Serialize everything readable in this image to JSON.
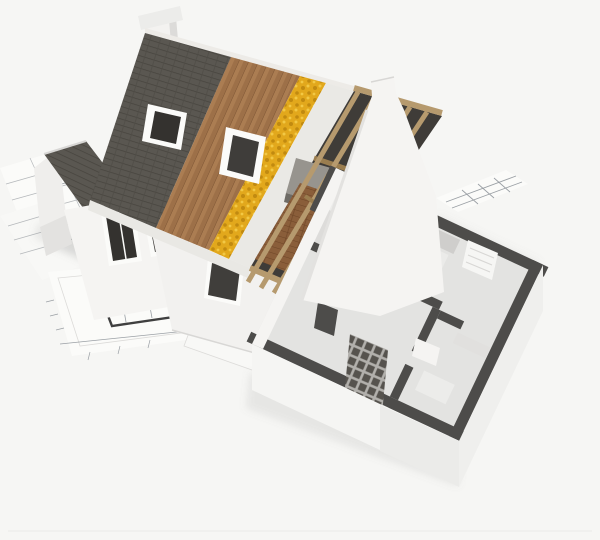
{
  "image": {
    "alt": "3D architectural cutaway rendering of a house under construction standing on blueprint floor plans",
    "type": "3d-architectural-render",
    "elements": [
      "blueprint-sheets",
      "floor-plan-drawing",
      "chimney",
      "main-roof-shingles",
      "roof-wood-sheathing",
      "roof-insulation-layer",
      "roof-membrane",
      "exposed-rafters",
      "roof-window",
      "attic-interior",
      "attic-wood-floor",
      "dutch-gable-wall",
      "left-wing-gable",
      "facade-windows",
      "front-wall-window",
      "ground-floor-cutaway",
      "interior-partition-walls",
      "kitchen-units",
      "radiator",
      "masonry-lattice-wall"
    ]
  },
  "colors": {
    "bg": "#f6f6f4",
    "paper": "#fbfbf9",
    "paper2": "#f8f8f6",
    "paper_line": "#b5b8bb",
    "paper_line2": "#9ba0a5",
    "paper_wall": "#3f3f3f",
    "paper_edge": "#dcdbd9",
    "shadow": "#8a8a86",
    "chimney_cap": "#ececea",
    "chimney_body": "#f3f2f0",
    "chimney_side": "#dcdbd9",
    "shingle": "#5a5751",
    "shingle_line": "#47443e",
    "shingle_gap": "#504d47",
    "wood_a": "#ab7d52",
    "wood_b": "#9d7048",
    "wood_line": "#7e5635",
    "insul": "#e2a81c",
    "insul_dark": "#c18a10",
    "insul_light": "#f2c845",
    "membrane": "#eae9e5",
    "ridge_strip": "#edebe7",
    "eave_strip": "#e9e8e4",
    "attic": "#3f3c38",
    "attic_floor": "#8a5e3a",
    "attic_floor_line": "#6d4526",
    "furniture": "#97948e",
    "furniture_side": "#6e6b65",
    "rafter": "#b69a6e",
    "rafter_dark": "#9a7d4f",
    "frame": "#fbfbf9",
    "glass": "#34322f",
    "glass2": "#3f3d3a",
    "wall": "#f5f4f2",
    "wall2": "#f2f1ef",
    "wall3": "#efeeec",
    "wall_shade": "#e3e2e0",
    "seam": "#d8d7d5",
    "wall_top": "#4d4c4a",
    "floor_int": "#e3e3e1",
    "floor_shade": "#dddcda",
    "counter": "#cfcecc",
    "counter2": "#c5c4c2",
    "counter3": "#d5d4d2",
    "appliance": "#ebebe9",
    "block": "#ececea",
    "block2": "#e1e0de",
    "lattice_bg": "#b2b0ac",
    "lattice_cell": "#56534e",
    "radiator": "#f6f6f4",
    "white_face": "#f5f5f3",
    "face_shade": "#ebebe9",
    "face_right": "#efefed",
    "win_small": "#403e3b",
    "bottom_line": "#ebebe9"
  }
}
